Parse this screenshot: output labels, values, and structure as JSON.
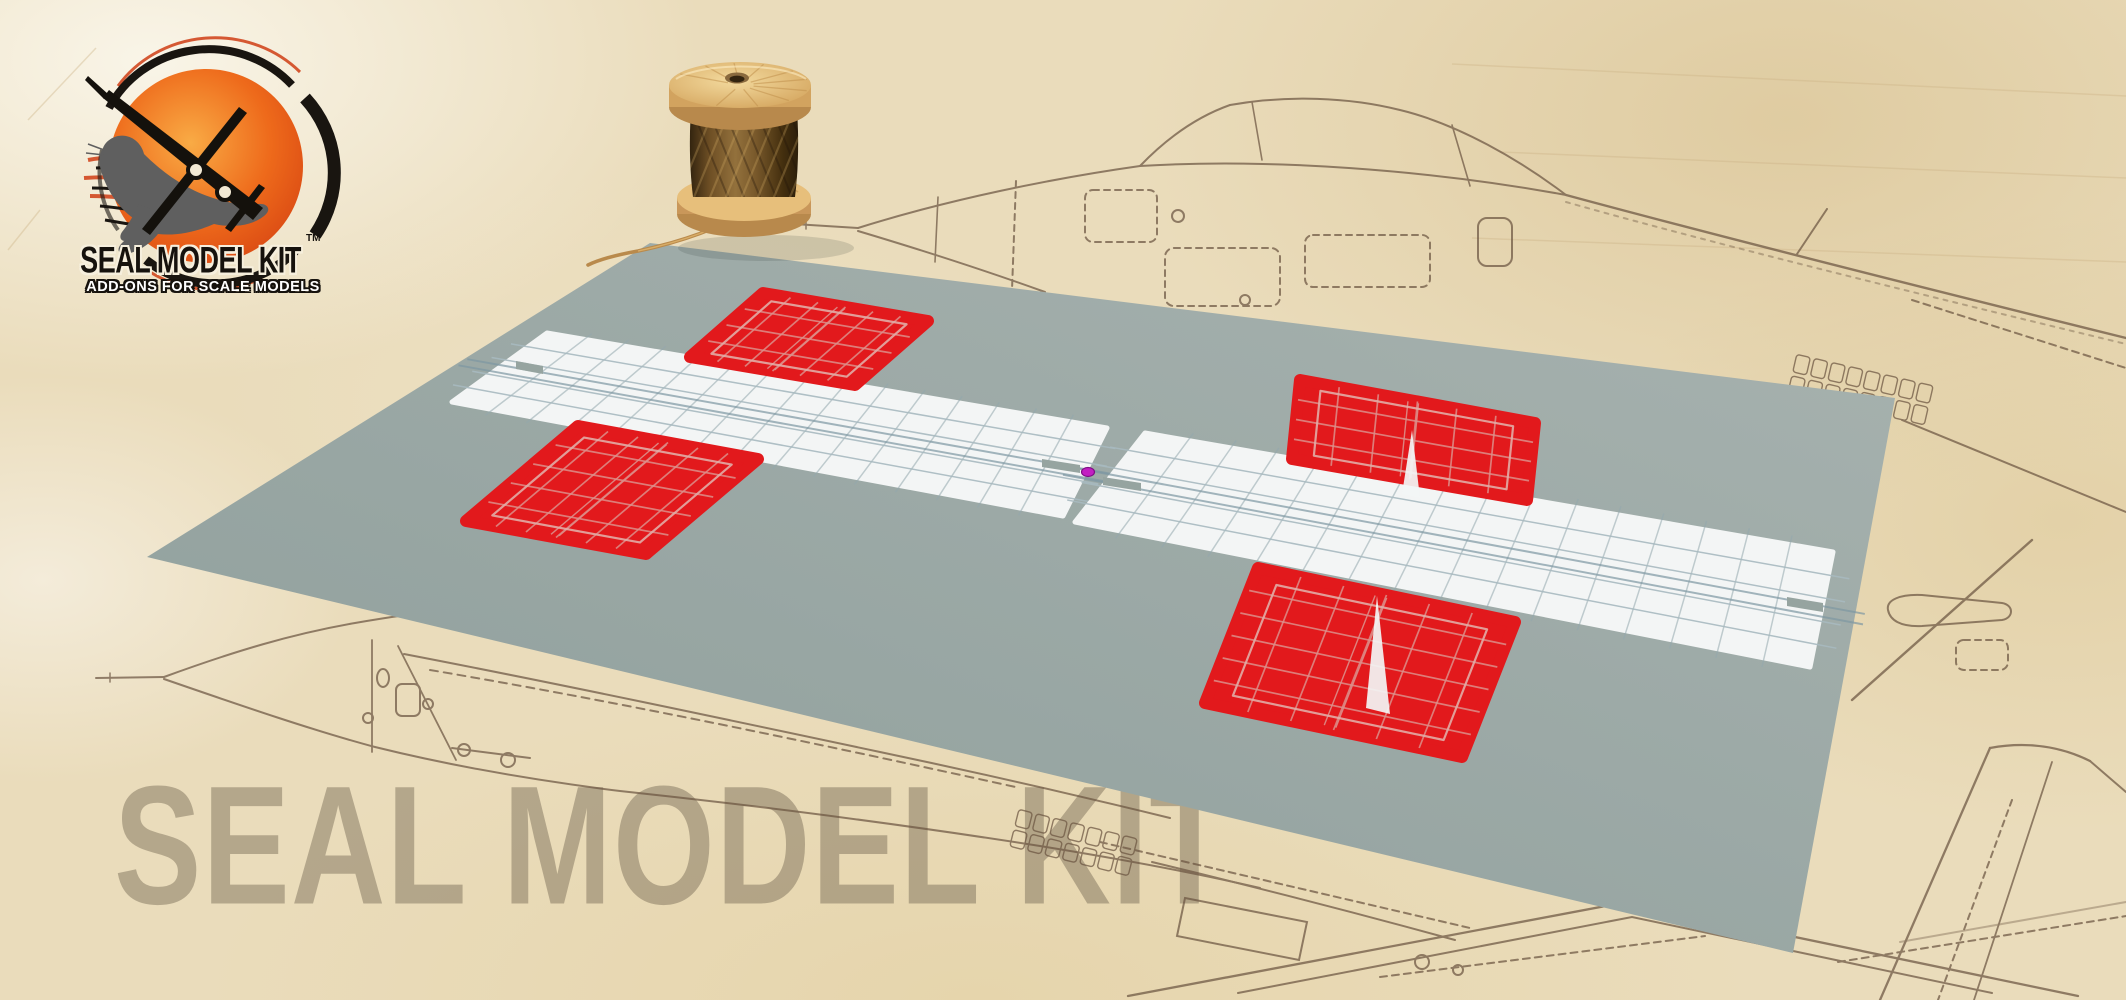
{
  "brand": {
    "logo_title": "SEAL MODEL KIT",
    "logo_trademark": "TM",
    "logo_tagline": "ADD-ONS FOR SCALE MODELS"
  },
  "watermark": {
    "text": "SEAL MODEL KIT"
  },
  "scene": {
    "objects": {
      "spool": "wooden-thread-spool",
      "mat": "grey-cutting-mat",
      "sheets": "red-white-flag-texture-nets",
      "marker": "magenta-origin-dot",
      "background": "aircraft-blueprint-parchment"
    },
    "colors": {
      "flag_red": "#e2191c",
      "red_grid": "#dd8f8a",
      "red_inset": "#e2aca6",
      "strip_white": "#f3f5f5",
      "grid_blue": "#93a8ae",
      "grid_blue_light": "#a8bac0",
      "seam_blue": "#7e98a3",
      "mat_gray": "#96a4a0",
      "mat_light": "#a7b2af",
      "mat_dark": "#8e9e9b",
      "parchment": "#ecdfc2",
      "sketch_brown": "#6a5440",
      "wood_light": "#eac87f",
      "thread_brown": "#6b4e28",
      "origin_magenta": "#c21fc2",
      "watermark_gray": "#685e4b",
      "logo_orange": "#ee6a1b"
    }
  }
}
